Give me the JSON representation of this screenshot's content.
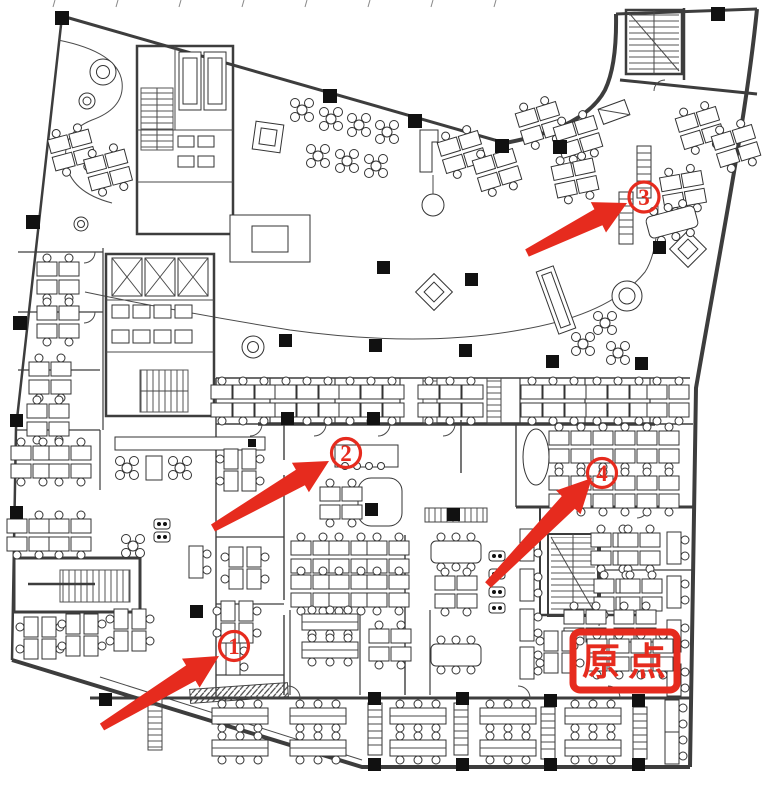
{
  "figure": {
    "kind": "office floor plan drawing",
    "background": "#ffffff",
    "line_color": "#3d3d3d"
  },
  "annotations": {
    "color": "#e62b1e",
    "markers": [
      {
        "label": "1",
        "x": 234,
        "y": 646
      },
      {
        "label": "2",
        "x": 346,
        "y": 453
      },
      {
        "label": "3",
        "x": 644,
        "y": 197
      },
      {
        "label": "4",
        "x": 602,
        "y": 473
      }
    ],
    "origin": {
      "label": "原点",
      "x": 624,
      "y": 661
    }
  }
}
